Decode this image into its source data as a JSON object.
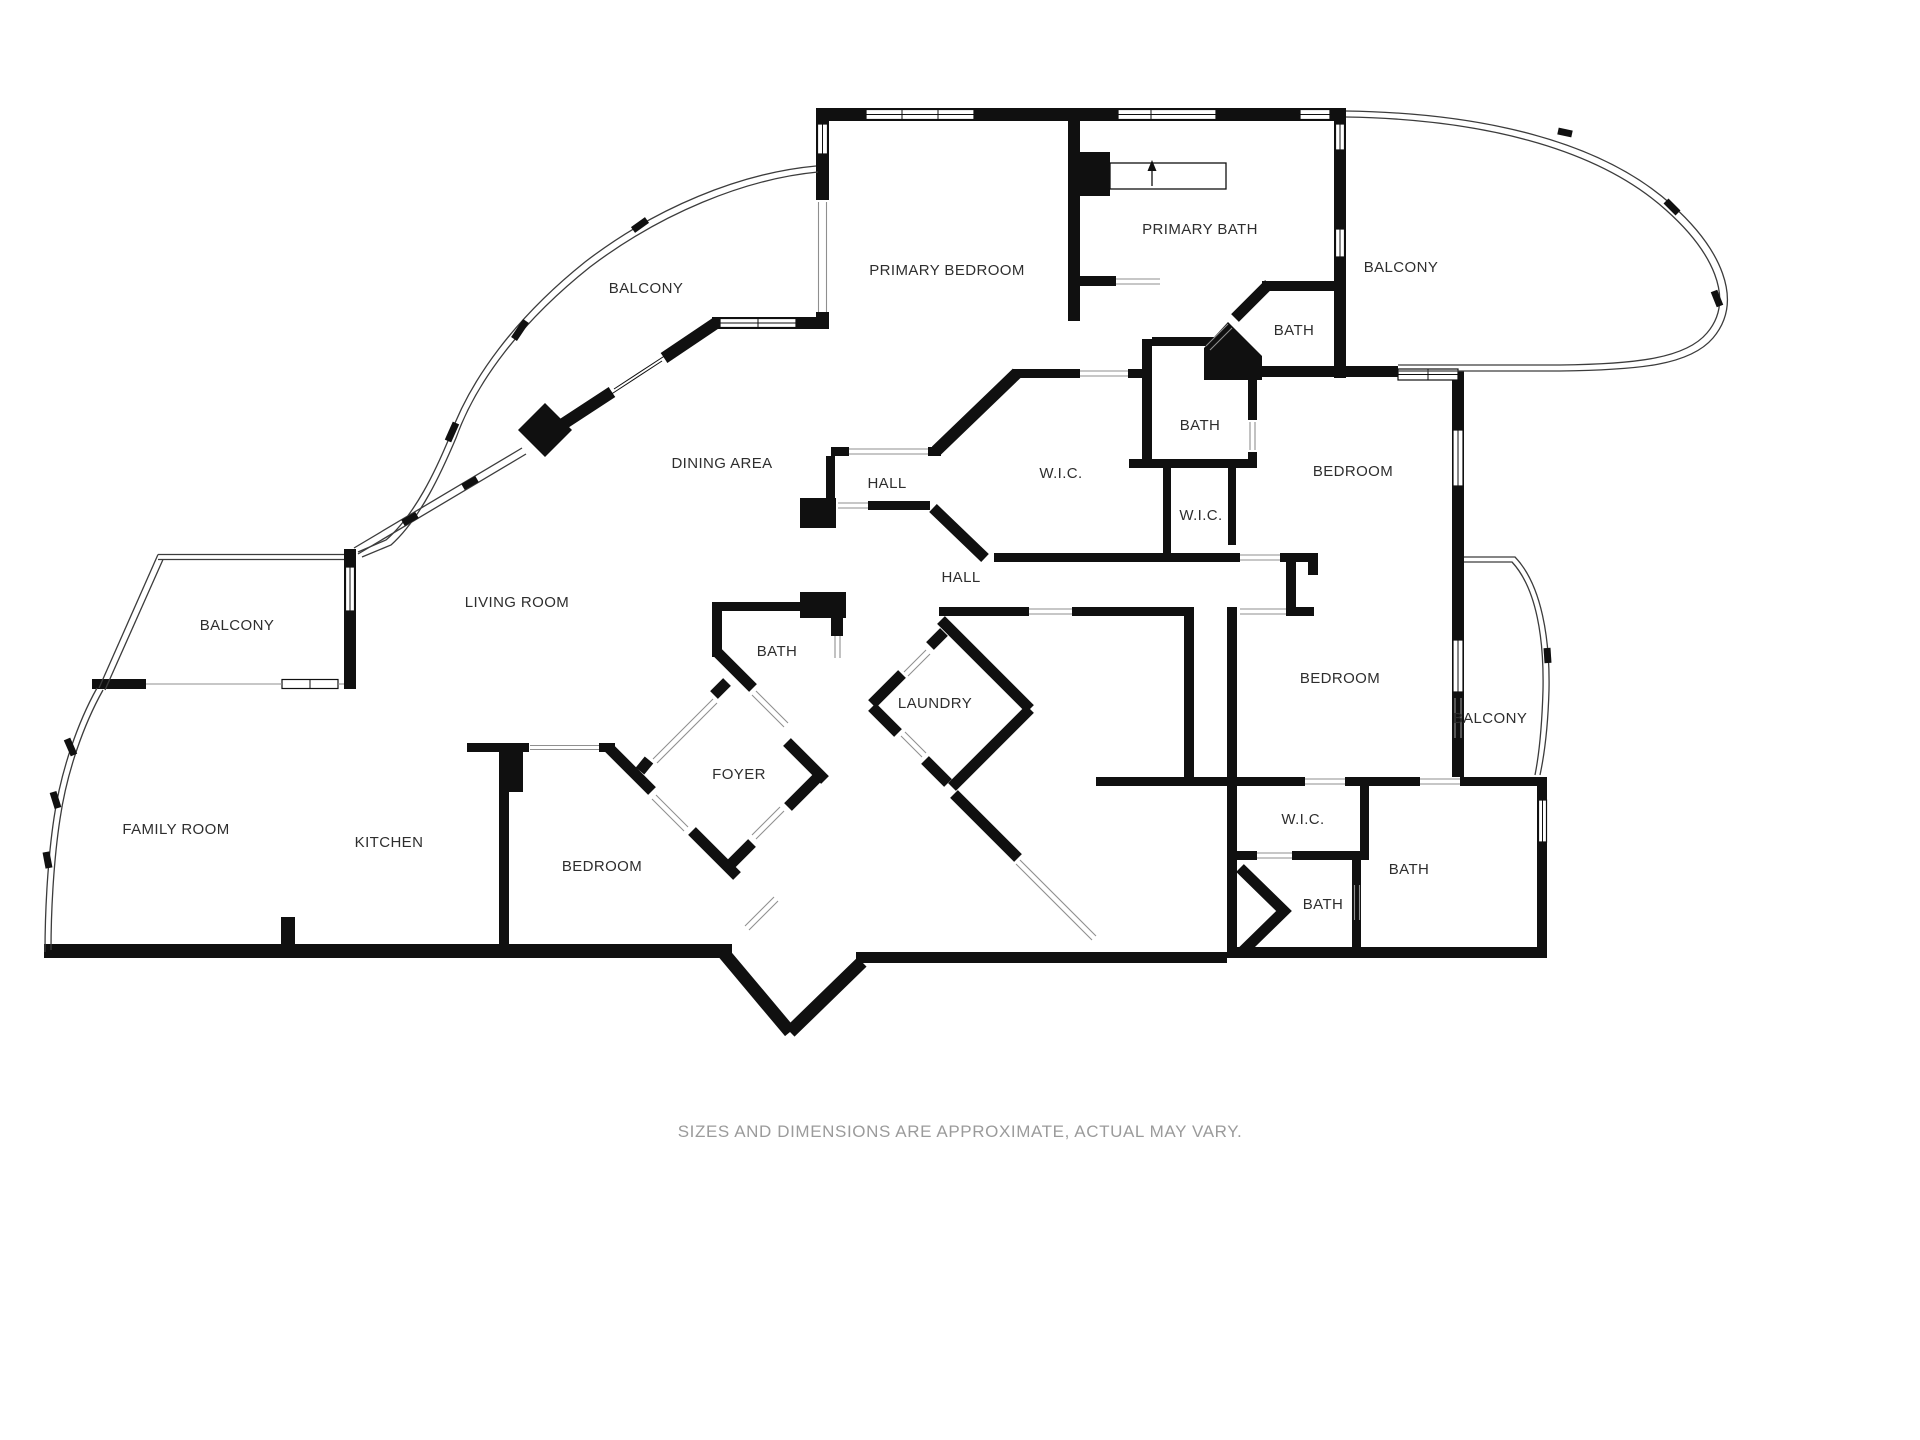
{
  "plan": {
    "colors": {
      "background": "#ffffff",
      "wall": "#101010",
      "rail": "#3c3c3c",
      "door_line": "#8f8f8f",
      "label_text": "#2e2e2e",
      "footer_text": "#9b9b9b"
    },
    "rooms": [
      {
        "id": "balcony-top-left",
        "label": "BALCONY"
      },
      {
        "id": "primary-bedroom",
        "label": "PRIMARY BEDROOM"
      },
      {
        "id": "primary-bath",
        "label": "PRIMARY BATH"
      },
      {
        "id": "balcony-top-right",
        "label": "BALCONY"
      },
      {
        "id": "bath-primary-suite",
        "label": "BATH"
      },
      {
        "id": "dining-area",
        "label": "DINING AREA"
      },
      {
        "id": "hall-upper",
        "label": "HALL"
      },
      {
        "id": "bath-middle",
        "label": "BATH"
      },
      {
        "id": "wic-large",
        "label": "W.I.C."
      },
      {
        "id": "wic-small",
        "label": "W.I.C."
      },
      {
        "id": "bedroom-upper-right",
        "label": "BEDROOM"
      },
      {
        "id": "hall-lower",
        "label": "HALL"
      },
      {
        "id": "balcony-left",
        "label": "BALCONY"
      },
      {
        "id": "living-room",
        "label": "LIVING ROOM"
      },
      {
        "id": "bath-center",
        "label": "BATH"
      },
      {
        "id": "laundry",
        "label": "LAUNDRY"
      },
      {
        "id": "bedroom-lower-right",
        "label": "BEDROOM"
      },
      {
        "id": "balcony-lower-right",
        "label": "BALCONY"
      },
      {
        "id": "foyer",
        "label": "FOYER"
      },
      {
        "id": "family-room",
        "label": "FAMILY ROOM"
      },
      {
        "id": "kitchen",
        "label": "KITCHEN"
      },
      {
        "id": "bedroom-bottom-center",
        "label": "BEDROOM"
      },
      {
        "id": "wic-lower-right",
        "label": "W.I.C."
      },
      {
        "id": "bath-lower-right-east",
        "label": "BATH"
      },
      {
        "id": "bath-lower-right-south",
        "label": "BATH"
      }
    ]
  },
  "footer": {
    "disclaimer": "SIZES AND DIMENSIONS ARE APPROXIMATE, ACTUAL MAY VARY."
  }
}
